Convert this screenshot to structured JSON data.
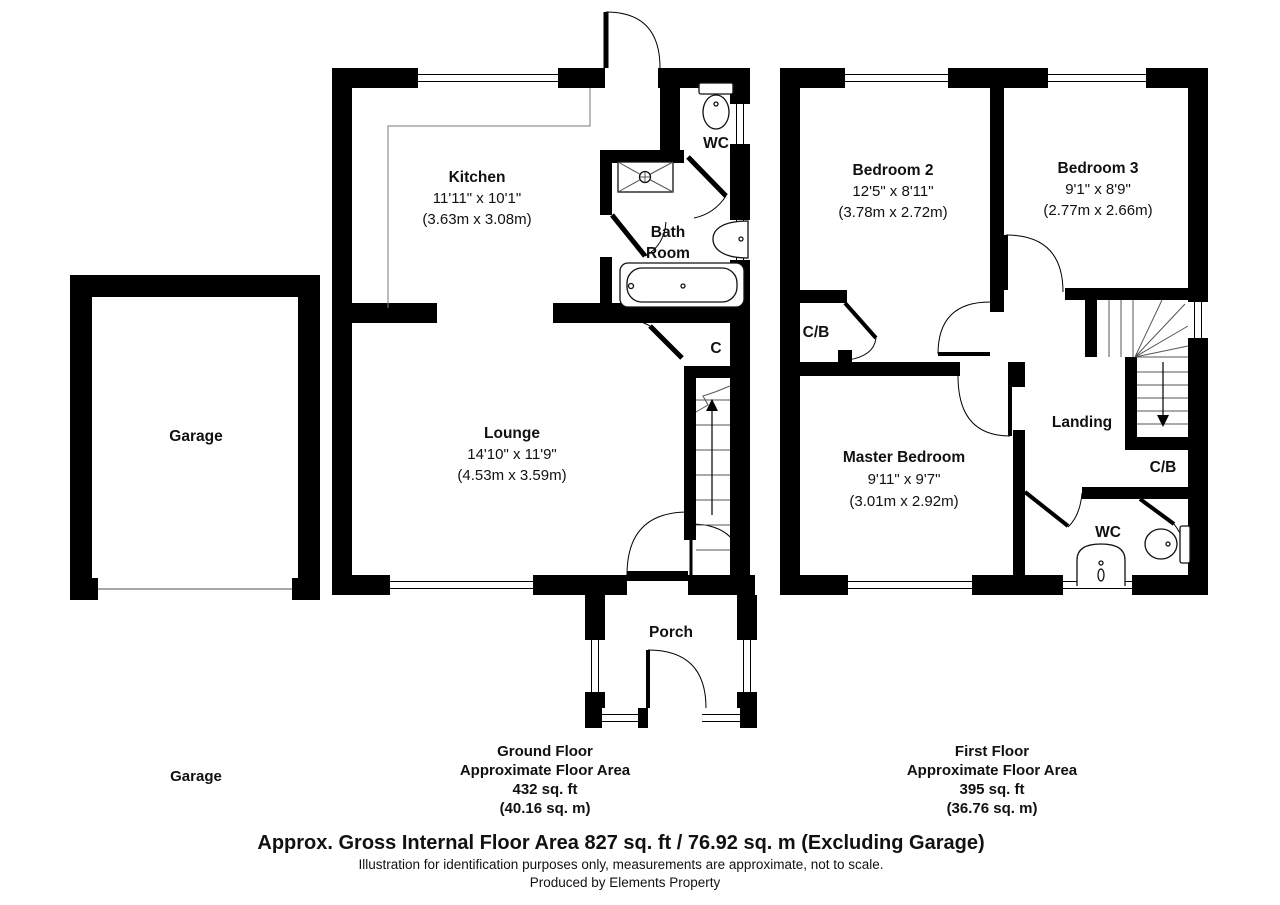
{
  "ground_floor": {
    "kitchen": {
      "name": "Kitchen",
      "size_imperial": "11'11\" x 10'1\"",
      "size_metric": "(3.63m x 3.08m)"
    },
    "lounge": {
      "name": "Lounge",
      "size_imperial": "14'10\" x 11'9\"",
      "size_metric": "(4.53m x 3.59m)"
    },
    "wc_label": "WC",
    "bath_line1": "Bath",
    "bath_line2": "Room",
    "cupboard_label": "C",
    "porch_label": "Porch",
    "caption": {
      "title": "Ground Floor",
      "subtitle": "Approximate Floor Area",
      "area_ft": "432 sq. ft",
      "area_m": "(40.16 sq. m)"
    }
  },
  "first_floor": {
    "bedroom2": {
      "name": "Bedroom 2",
      "size_imperial": "12'5\" x 8'11\"",
      "size_metric": "(3.78m x 2.72m)"
    },
    "bedroom3": {
      "name": "Bedroom 3",
      "size_imperial": "9'1\" x 8'9\"",
      "size_metric": "(2.77m x 2.66m)"
    },
    "master_bedroom": {
      "name": "Master Bedroom",
      "size_imperial": "9'11\" x 9'7\"",
      "size_metric": "(3.01m x 2.92m)"
    },
    "landing_label": "Landing",
    "cupboard_left_label": "C/B",
    "cupboard_right_label": "C/B",
    "wc_label": "WC",
    "caption": {
      "title": "First Floor",
      "subtitle": "Approximate Floor Area",
      "area_ft": "395 sq. ft",
      "area_m": "(36.76 sq. m)"
    }
  },
  "garage": {
    "room_label": "Garage",
    "caption": "Garage"
  },
  "footer": {
    "headline": "Approx. Gross Internal Floor Area 827 sq. ft / 76.92 sq. m (Excluding Garage)",
    "disclaimer": "Illustration for identification purposes only, measurements are approximate, not to scale.",
    "credit": "Produced by Elements Property"
  },
  "colors": {
    "wall": "#000000",
    "background": "#ffffff"
  }
}
